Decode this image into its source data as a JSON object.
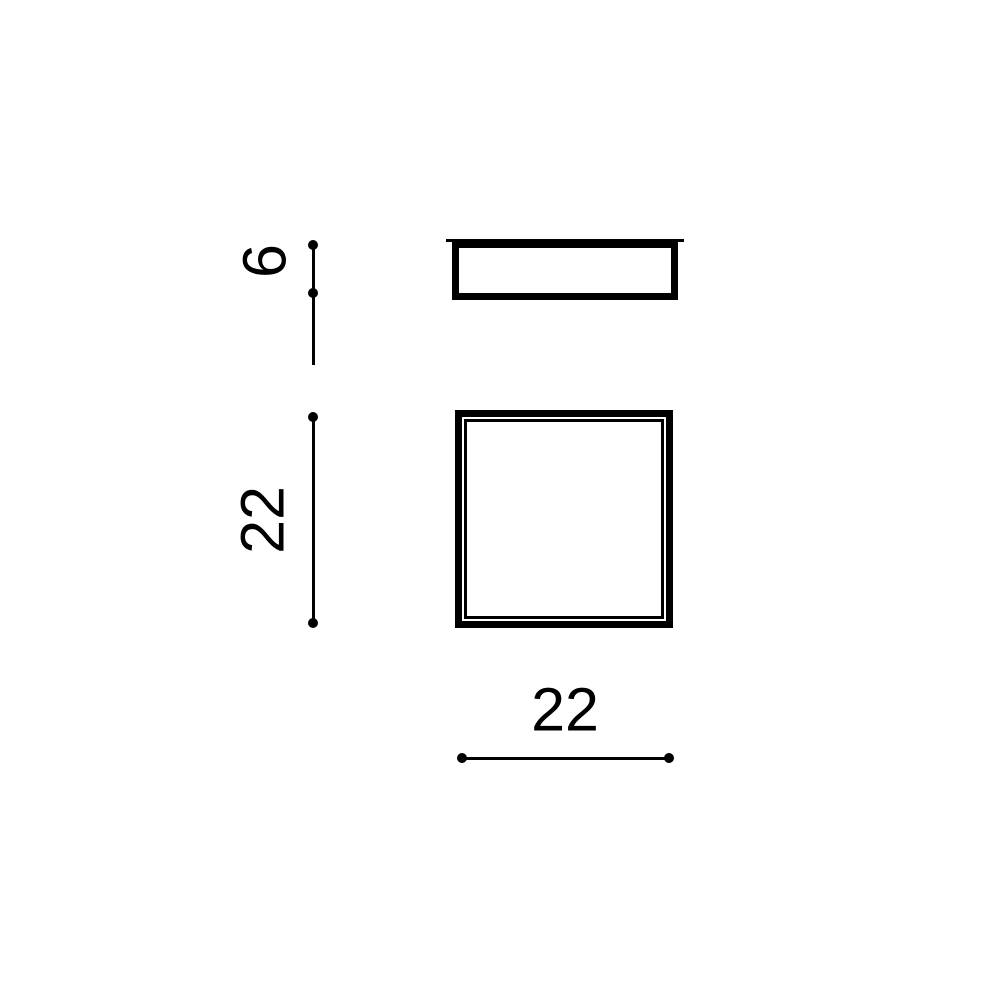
{
  "drawing": {
    "type": "technical-dimension-drawing",
    "views": {
      "side_view": {
        "description": "side profile of fixture with top flange",
        "height_label": "6"
      },
      "front_view": {
        "description": "square face with inner frame line",
        "height_label": "22",
        "width_label": "22"
      }
    },
    "colors": {
      "line": "#000000",
      "background": "#ffffff"
    }
  }
}
